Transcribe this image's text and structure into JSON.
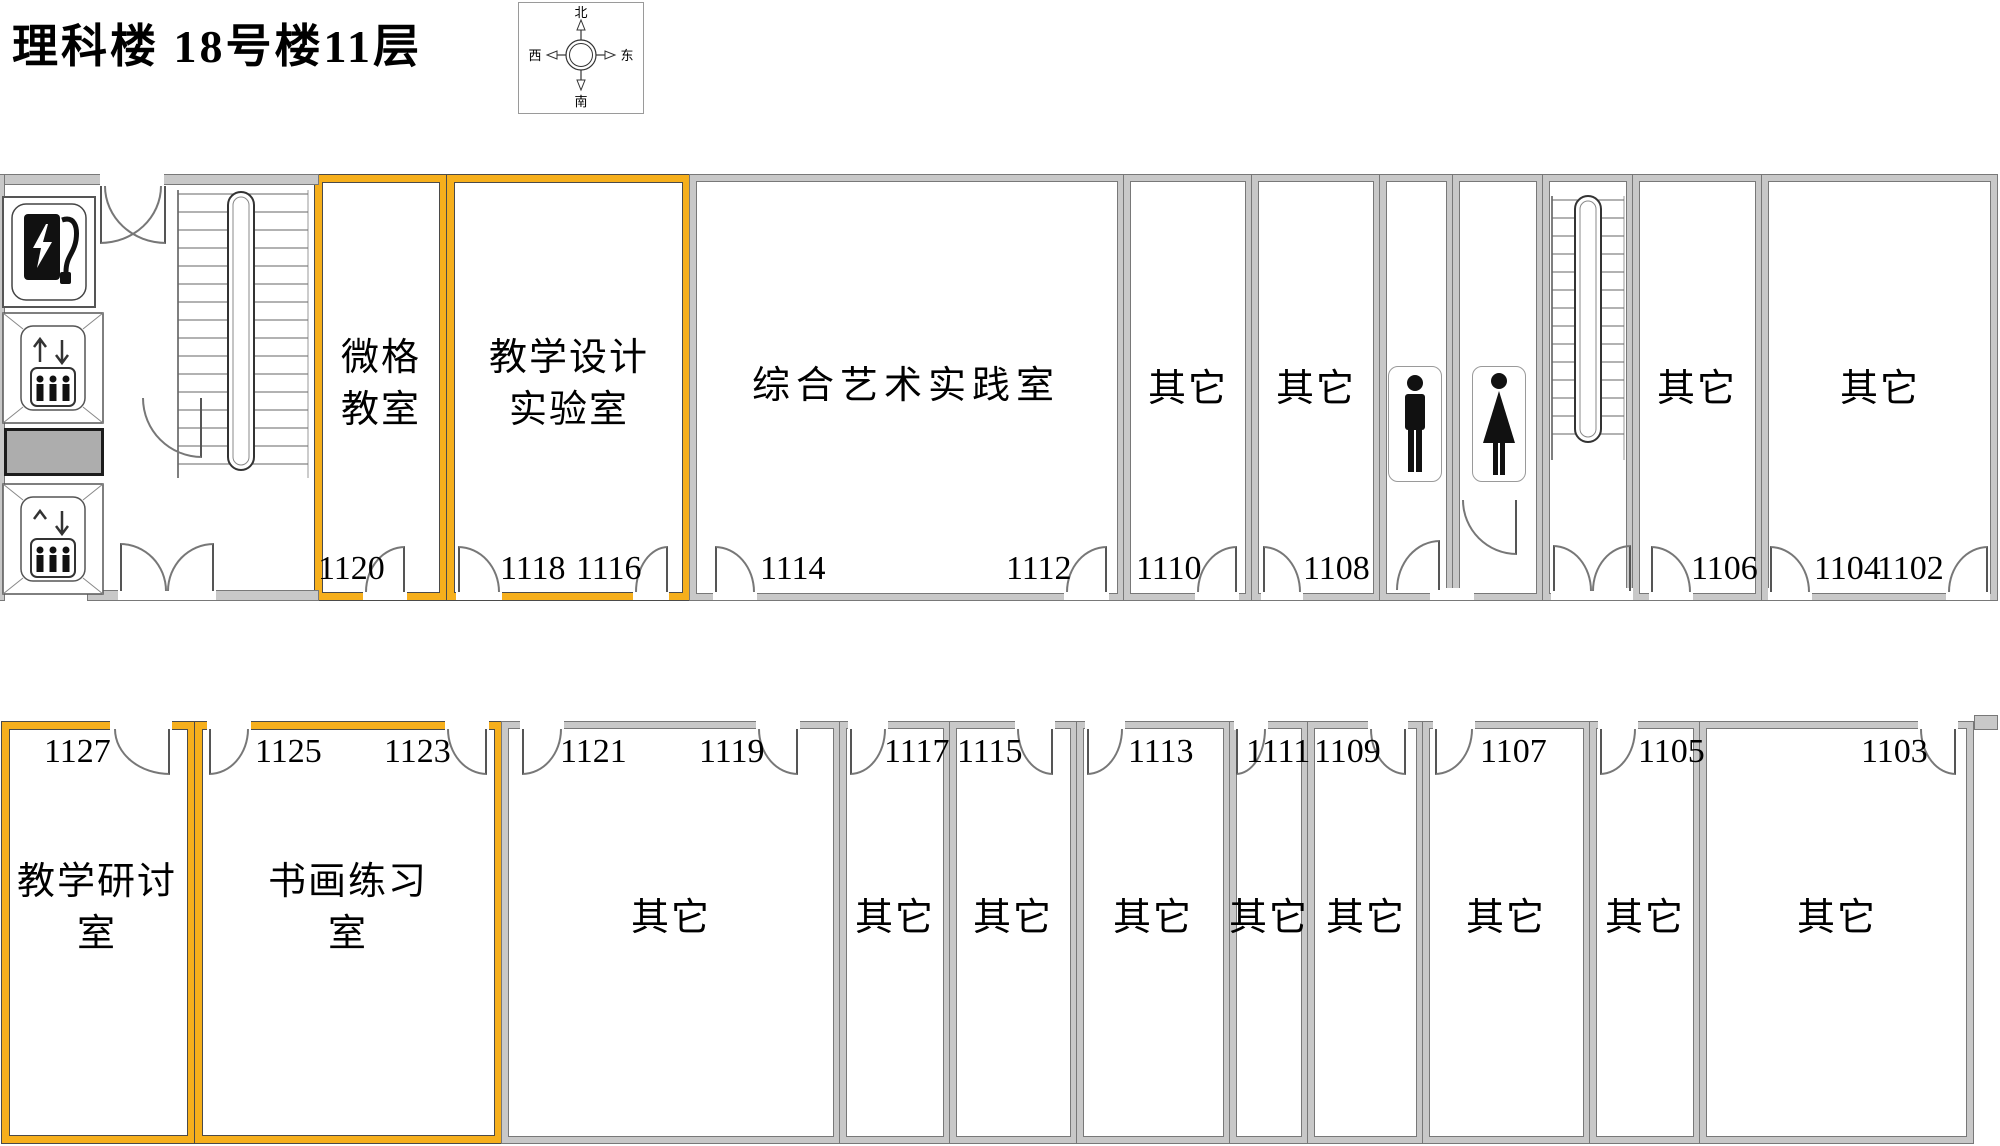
{
  "title": "理科楼  18号楼11层",
  "compass": {
    "north": "北",
    "south": "南",
    "east": "东",
    "west": "西"
  },
  "colors": {
    "highlight_wall": "#F6AF1C",
    "wall_gray": "#C8C8C8",
    "elevator_shaft": "#ADADAD"
  },
  "icons": {
    "compass": "compass-rose-icon",
    "charging_room": "charging-station-icon",
    "elevators": "elevator-icon",
    "stairwells": "staircase-icon",
    "mens_room": "male-figure-icon",
    "womens_room": "female-figure-icon"
  },
  "top_wing": {
    "rooms": [
      {
        "lines": [
          "微格",
          "教室"
        ],
        "numbers": [
          "1120"
        ],
        "highlighted": true
      },
      {
        "lines": [
          "教学设计",
          "实验室"
        ],
        "numbers": [
          "1118",
          "1116"
        ],
        "highlighted": true
      },
      {
        "lines": [
          "综合艺术实践室"
        ],
        "numbers": [
          "1114",
          "1112"
        ],
        "highlighted": false
      },
      {
        "lines": [
          "其它"
        ],
        "numbers": [
          "1110"
        ],
        "highlighted": false
      },
      {
        "lines": [
          "其它"
        ],
        "numbers": [
          "1108"
        ],
        "highlighted": false
      },
      {
        "lines": [],
        "numbers": [],
        "highlighted": false,
        "icon": "male-figure-icon"
      },
      {
        "lines": [],
        "numbers": [],
        "highlighted": false,
        "icon": "female-figure-icon"
      },
      {
        "lines": [],
        "numbers": [],
        "highlighted": false,
        "icon": "staircase-icon"
      },
      {
        "lines": [
          "其它"
        ],
        "numbers": [
          "1106"
        ],
        "highlighted": false
      },
      {
        "lines": [
          "其它"
        ],
        "numbers": [
          "1104",
          "1102"
        ],
        "highlighted": false
      }
    ]
  },
  "bottom_wing": {
    "rooms": [
      {
        "lines": [
          "教学研讨",
          "室"
        ],
        "numbers": [
          "1127"
        ],
        "highlighted": true
      },
      {
        "lines": [
          "书画练习",
          "室"
        ],
        "numbers": [
          "1125",
          "1123"
        ],
        "highlighted": true
      },
      {
        "lines": [
          "其它"
        ],
        "numbers": [
          "1121",
          "1119"
        ],
        "highlighted": false
      },
      {
        "lines": [
          "其它"
        ],
        "numbers": [
          "1117"
        ],
        "highlighted": false
      },
      {
        "lines": [
          "其它"
        ],
        "numbers": [
          "1115"
        ],
        "highlighted": false
      },
      {
        "lines": [
          "其它"
        ],
        "numbers": [
          "1113"
        ],
        "highlighted": false
      },
      {
        "lines": [
          "其它"
        ],
        "numbers": [
          "1111"
        ],
        "highlighted": false
      },
      {
        "lines": [
          "其它"
        ],
        "numbers": [
          "1109"
        ],
        "highlighted": false
      },
      {
        "lines": [
          "其它"
        ],
        "numbers": [
          "1107"
        ],
        "highlighted": false
      },
      {
        "lines": [
          "其它"
        ],
        "numbers": [
          "1105"
        ],
        "highlighted": false
      },
      {
        "lines": [
          "其它"
        ],
        "numbers": [
          "1103"
        ],
        "highlighted": false
      }
    ]
  }
}
